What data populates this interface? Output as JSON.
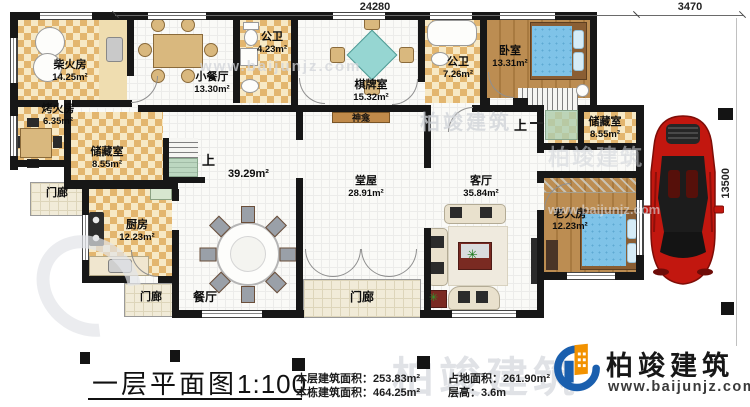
{
  "plan": {
    "dimensions": {
      "top": "24280",
      "top_right": "3470",
      "right": "13500"
    },
    "rooms": [
      {
        "name": "柴火房",
        "area": "14.25m²"
      },
      {
        "name": "小餐厅",
        "area": "13.30m²"
      },
      {
        "name": "公卫",
        "area": "4.23m²"
      },
      {
        "name": "棋牌室",
        "area": "15.32m²"
      },
      {
        "name": "公卫",
        "area": "7.26m²"
      },
      {
        "name": "卧室",
        "area": "13.31m²"
      },
      {
        "name": "烤火房",
        "area": "6.35m²"
      },
      {
        "name": "储藏室",
        "area": "8.55m²"
      },
      {
        "name": "储藏室",
        "area": "8.55m²"
      },
      {
        "name": "厨房",
        "area": "12.23m²"
      },
      {
        "name": "堂屋",
        "area": "28.91m²"
      },
      {
        "name": "客厅",
        "area": "35.84m²"
      },
      {
        "name": "老人房",
        "area": "12.23m²"
      }
    ],
    "labels": {
      "shrine": "神龛",
      "up": "上",
      "porch": "门廊",
      "dining_hall": "餐厅",
      "open_area": "39.29m²"
    }
  },
  "title_block": {
    "title": "一层平面图",
    "scale": "1:100",
    "stats": [
      {
        "label": "本层建筑面积：",
        "value": "253.83m²"
      },
      {
        "label": "本栋建筑面积：",
        "value": "464.25m²"
      },
      {
        "label": "占地面积：",
        "value": "261.90m²"
      },
      {
        "label": "层高：",
        "value": "3.6m"
      }
    ]
  },
  "logo": {
    "name": "柏竣建筑",
    "website": "www.baijunjz.com"
  },
  "watermark": {
    "brand": "柏竣建筑",
    "site": "www.baijunjz.com"
  },
  "colors": {
    "wall": "#171717",
    "checker_dark": "#e3b66f",
    "checker_light": "#f7e9c6",
    "wood": "#b5854c",
    "bed_blue": "#7fc3e8",
    "mahjong_teal": "#96d6d2",
    "logo_blue": "#1a5fae",
    "logo_orange": "#f29200",
    "car_red": "#c2170f"
  }
}
